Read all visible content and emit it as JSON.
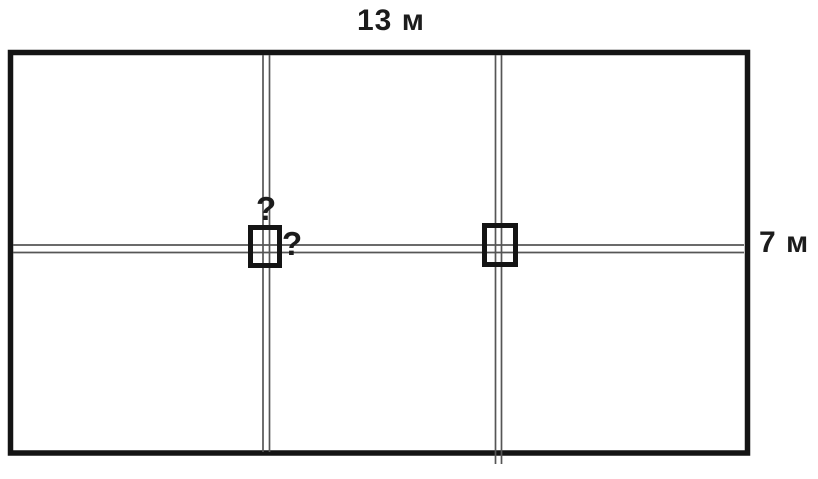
{
  "labels": {
    "top_dimension": "13 м",
    "right_dimension": "7 м",
    "unknown_above_post": "?",
    "unknown_beside_post": "?"
  },
  "colors": {
    "background": "#ffffff",
    "outline": "#141414",
    "path_line": "#565656",
    "text": "#1c1c1c"
  }
}
